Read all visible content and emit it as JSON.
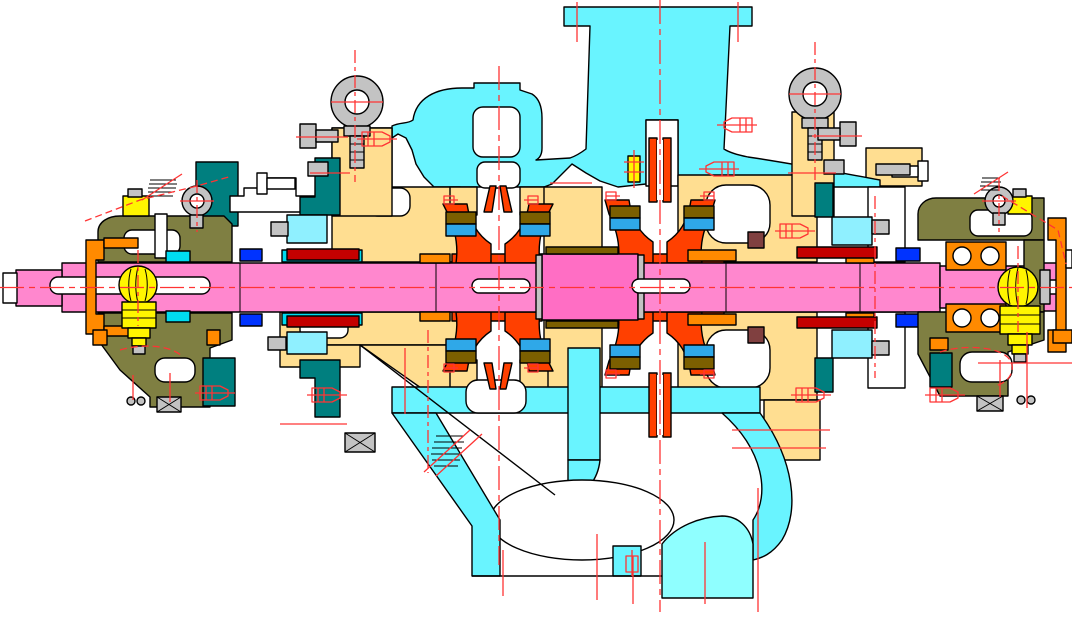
{
  "drawing": {
    "type": "engineering-cad-cross-section",
    "subject": "two-stage centrifugal pump, axial cross-section",
    "canvas": {
      "width": 1072,
      "height": 622
    }
  },
  "palette": {
    "background": "#FFFFFF",
    "outline": "#000000",
    "casing_cyan": "#69F4FF",
    "suction_cyan": "#8FFFFF",
    "gland_cyan": "#8FF0FF",
    "bright_cyan": "#00DCF0",
    "diffuser_tan": "#FFDE91",
    "shaft_pink": "#FF87CE",
    "hub_pink": "#FF6EC4",
    "impeller_red": "#FF4000",
    "orange": "#FF8A00",
    "olive": "#7F7F42",
    "dark_olive": "#7C5F00",
    "wear_blue": "#2FA8E8",
    "bolt_blue": "#0033FF",
    "teal": "#007F7F",
    "bearing_yellow": "#FFF500",
    "gray": "#C3C3C3",
    "dark_gray": "#8F8F8F",
    "seal_dark_red": "#C40000",
    "brown": "#804040",
    "pale_green": "#9FE89F",
    "centerline_red": "#FF3434"
  },
  "parts": [
    {
      "name": "discharge-nozzle-flange",
      "color": "casing_cyan"
    },
    {
      "name": "volute-casing",
      "color": "casing_cyan"
    },
    {
      "name": "suction-chamber",
      "color": "suction_cyan"
    },
    {
      "name": "diffuser-inner-casing",
      "color": "diffuser_tan"
    },
    {
      "name": "impeller-stage-1",
      "color": "impeller_red"
    },
    {
      "name": "impeller-stage-2",
      "color": "impeller_red"
    },
    {
      "name": "pump-shaft",
      "color": "shaft_pink"
    },
    {
      "name": "shaft-center-hub",
      "color": "hub_pink"
    },
    {
      "name": "shaft-keyway",
      "color": "background"
    },
    {
      "name": "wear-ring",
      "color": "wear_blue"
    },
    {
      "name": "wear-ring-seat",
      "color": "dark_olive"
    },
    {
      "name": "bearing-housing-left",
      "color": "olive"
    },
    {
      "name": "bearing-housing-right",
      "color": "olive"
    },
    {
      "name": "ball-bearing-left",
      "color": "bearing_yellow"
    },
    {
      "name": "ball-bearing-right",
      "color": "bearing_yellow"
    },
    {
      "name": "thrust-bearing-duplex",
      "color": "orange"
    },
    {
      "name": "bearing-end-cover",
      "color": "orange"
    },
    {
      "name": "mechanical-seal-gland",
      "color": "gland_cyan"
    },
    {
      "name": "seal-rings",
      "color": "seal_dark_red"
    },
    {
      "name": "gland-bracket",
      "color": "teal"
    },
    {
      "name": "lifting-eyebolt",
      "color": "gray"
    },
    {
      "name": "mounting-pad",
      "color": "gray"
    },
    {
      "name": "balance-bushing",
      "color": "orange"
    },
    {
      "name": "centerlines",
      "color": "centerline_red"
    }
  ]
}
